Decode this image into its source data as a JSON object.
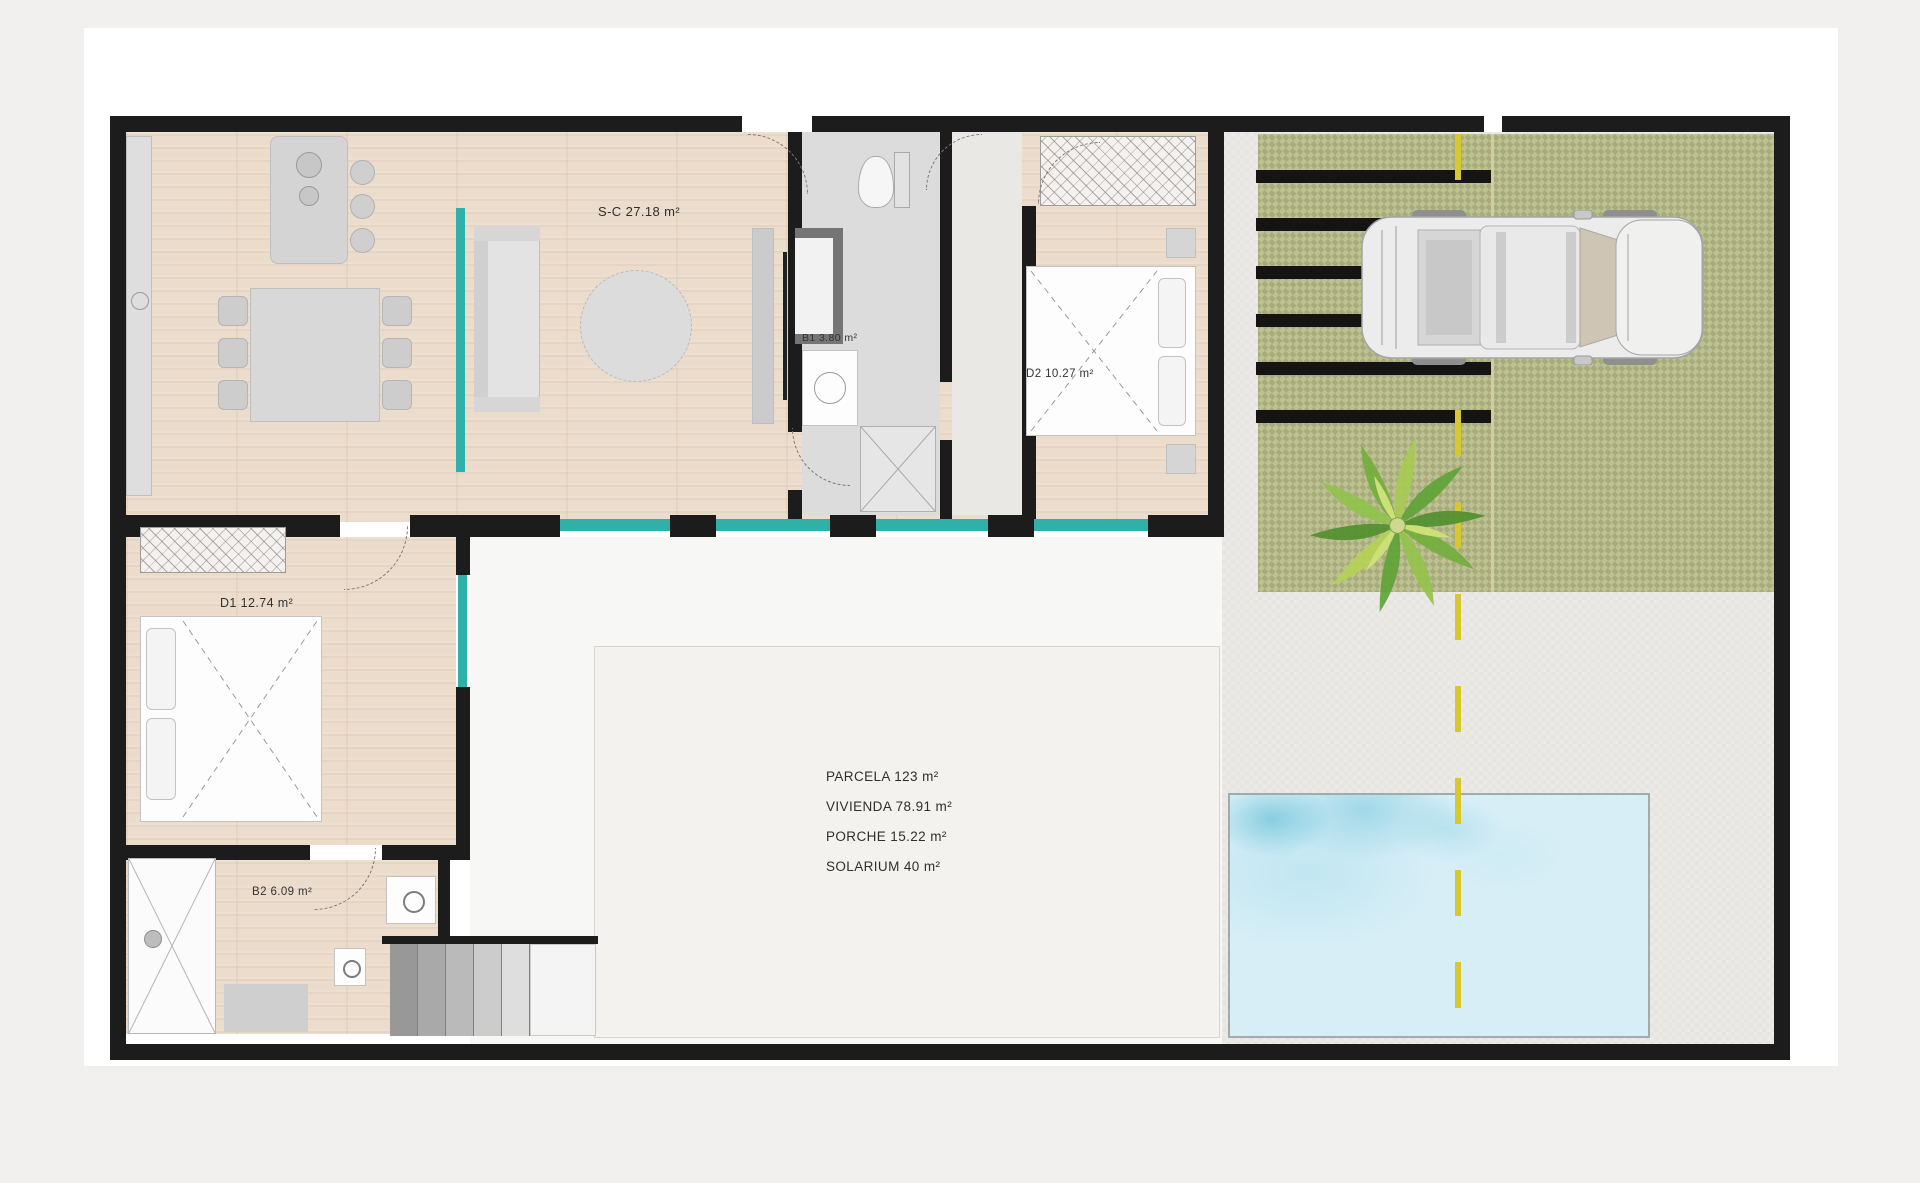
{
  "rooms": {
    "living_kitchen": {
      "label": "S-C 27.18 m²"
    },
    "bathroom1": {
      "label": "B1 3.80 m²"
    },
    "bedroom2": {
      "label": "D2 10.27 m²"
    },
    "bedroom1": {
      "label": "D1 12.74 m²"
    },
    "bathroom2": {
      "label": "B2 6.09 m²"
    }
  },
  "summary": {
    "parcela": "PARCELA 123 m²",
    "vivienda": "VIVIENDA 78.91 m²",
    "porche": "PORCHE 15.22 m²",
    "solarium": "SOLARIUM 40 m²"
  },
  "icons": {
    "palm_tree": "palm-tree-icon",
    "car": "car-top-view-icon",
    "shower_head": "shower-head-icon",
    "washing_machine": "washing-machine-icon",
    "sink": "sink-icon",
    "toilet": "toilet-icon"
  },
  "colors": {
    "wall": "#1c1c1c",
    "wood_floor": "#ecdccc",
    "tile_floor": "#dcdcdc",
    "glazing_teal": "#2fb0a8",
    "grass": "#b9bc8e",
    "pool_water": "#d8eef6",
    "pool_water_deep": "#7ecbdd",
    "road_line_yellow": "#d8c82e",
    "car_body": "#ececec"
  }
}
